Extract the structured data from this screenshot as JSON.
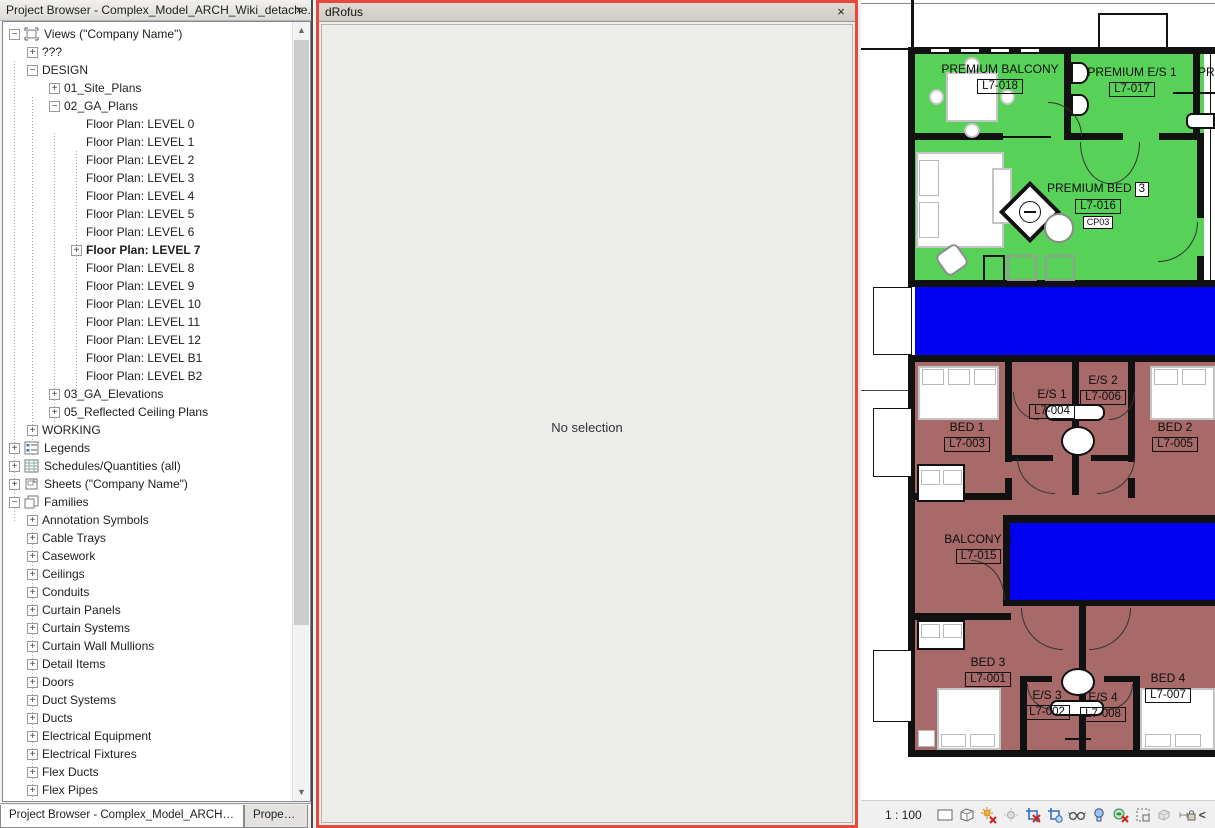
{
  "project_browser": {
    "title": "Project Browser - Complex_Model_ARCH_Wiki_detache...",
    "close_glyph": "×",
    "tree": [
      {
        "label": "Views (\"Company Name\")",
        "depth": 0,
        "exp": "minus",
        "icon": "views"
      },
      {
        "label": "???",
        "depth": 1,
        "exp": "plus"
      },
      {
        "label": "DESIGN",
        "depth": 1,
        "exp": "minus"
      },
      {
        "label": "01_Site_Plans",
        "depth": 2,
        "exp": "plus"
      },
      {
        "label": "02_GA_Plans",
        "depth": 2,
        "exp": "minus"
      },
      {
        "label": "Floor Plan: LEVEL 0",
        "depth": 3
      },
      {
        "label": "Floor Plan: LEVEL 1",
        "depth": 3
      },
      {
        "label": "Floor Plan: LEVEL 2",
        "depth": 3
      },
      {
        "label": "Floor Plan: LEVEL 3",
        "depth": 3
      },
      {
        "label": "Floor Plan: LEVEL 4",
        "depth": 3
      },
      {
        "label": "Floor Plan: LEVEL 5",
        "depth": 3
      },
      {
        "label": "Floor Plan: LEVEL 6",
        "depth": 3
      },
      {
        "label": "Floor Plan: LEVEL 7",
        "depth": 3,
        "exp": "plus",
        "bold": true
      },
      {
        "label": "Floor Plan: LEVEL 8",
        "depth": 3
      },
      {
        "label": "Floor Plan: LEVEL 9",
        "depth": 3
      },
      {
        "label": "Floor Plan: LEVEL 10",
        "depth": 3
      },
      {
        "label": "Floor Plan: LEVEL 11",
        "depth": 3
      },
      {
        "label": "Floor Plan: LEVEL 12",
        "depth": 3
      },
      {
        "label": "Floor Plan: LEVEL B1",
        "depth": 3
      },
      {
        "label": "Floor Plan: LEVEL B2",
        "depth": 3
      },
      {
        "label": "03_GA_Elevations",
        "depth": 2,
        "exp": "plus"
      },
      {
        "label": "05_Reflected Ceiling Plans",
        "depth": 2,
        "exp": "plus"
      },
      {
        "label": "WORKING",
        "depth": 1,
        "exp": "plus"
      },
      {
        "label": "Legends",
        "depth": 0,
        "exp": "plus",
        "icon": "legends"
      },
      {
        "label": "Schedules/Quantities (all)",
        "depth": 0,
        "exp": "plus",
        "icon": "schedules"
      },
      {
        "label": "Sheets (\"Company Name\")",
        "depth": 0,
        "exp": "plus",
        "icon": "sheets"
      },
      {
        "label": "Families",
        "depth": 0,
        "exp": "minus",
        "icon": "families"
      },
      {
        "label": "Annotation Symbols",
        "depth": 1,
        "exp": "plus"
      },
      {
        "label": "Cable Trays",
        "depth": 1,
        "exp": "plus"
      },
      {
        "label": "Casework",
        "depth": 1,
        "exp": "plus"
      },
      {
        "label": "Ceilings",
        "depth": 1,
        "exp": "plus"
      },
      {
        "label": "Conduits",
        "depth": 1,
        "exp": "plus"
      },
      {
        "label": "Curtain Panels",
        "depth": 1,
        "exp": "plus"
      },
      {
        "label": "Curtain Systems",
        "depth": 1,
        "exp": "plus"
      },
      {
        "label": "Curtain Wall Mullions",
        "depth": 1,
        "exp": "plus"
      },
      {
        "label": "Detail Items",
        "depth": 1,
        "exp": "plus"
      },
      {
        "label": "Doors",
        "depth": 1,
        "exp": "plus"
      },
      {
        "label": "Duct Systems",
        "depth": 1,
        "exp": "plus"
      },
      {
        "label": "Ducts",
        "depth": 1,
        "exp": "plus"
      },
      {
        "label": "Electrical Equipment",
        "depth": 1,
        "exp": "plus"
      },
      {
        "label": "Electrical Fixtures",
        "depth": 1,
        "exp": "plus"
      },
      {
        "label": "Flex Ducts",
        "depth": 1,
        "exp": "plus"
      },
      {
        "label": "Flex Pipes",
        "depth": 1,
        "exp": "plus"
      }
    ],
    "tabs": [
      {
        "label": "Project Browser - Complex_Model_ARCH_Wi..."
      },
      {
        "label": "Properties"
      }
    ]
  },
  "drofus": {
    "title": "dRofus",
    "close_glyph": "×",
    "message": "No selection",
    "accent_border": "#e8483b"
  },
  "plan": {
    "colors": {
      "premium_green": "#57d157",
      "corridor_blue": "#0202f2",
      "bedroom_maroon": "#a76a68"
    },
    "rooms": [
      {
        "name": "PREMIUM BALCONY",
        "number": "L7-018"
      },
      {
        "name": "PREMIUM E/S 1",
        "number": "L7-017"
      },
      {
        "name": "PR",
        "number": ""
      },
      {
        "name": "PREMIUM BED",
        "bubble": "3",
        "number": "L7-016",
        "tag": "CP03"
      },
      {
        "name": "BED 1",
        "number": "L7-003"
      },
      {
        "name": "E/S 1",
        "number": "L7-004"
      },
      {
        "name": "E/S 2",
        "number": "L7-006"
      },
      {
        "name": "BED 2",
        "number": "L7-005"
      },
      {
        "name": "BALCONY X",
        "number": "L7-015"
      },
      {
        "name": "BED 3",
        "number": "L7-001"
      },
      {
        "name": "E/S 3",
        "number": "L7-002"
      },
      {
        "name": "E/S 4",
        "number": "L7-008"
      },
      {
        "name": "BED 4",
        "number": "L7-007"
      }
    ]
  },
  "status_bar": {
    "scale": "1 : 100",
    "icons": [
      "detail-level",
      "visual-style",
      "sun-path-off",
      "shadows-off",
      "crop-view-off",
      "show-crop-region",
      "reveal-hidden-elements",
      "temporary-hide-isolate",
      "worksharing-display-off",
      "temporary-view-properties",
      "displaced-elements",
      "reveal-constraints"
    ],
    "collapse_glyph": "<"
  }
}
